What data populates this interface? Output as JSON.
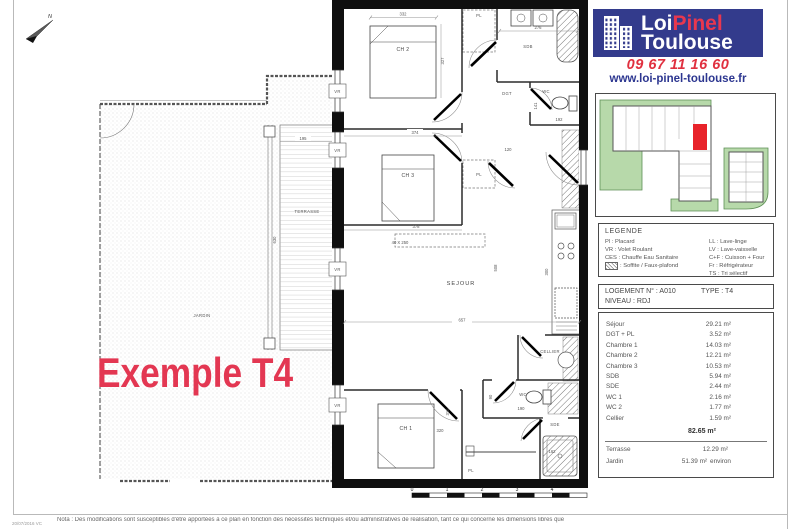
{
  "brand": {
    "logo": {
      "line1_a": "Loi",
      "line1_b": "Pinel",
      "line2": "Toulouse"
    },
    "phone": "09 67 11 16 60",
    "website": "www.loi-pinel-toulouse.fr",
    "colors": {
      "logo_bg": "#333b8c",
      "accent_red": "#e8374f",
      "site_highlight": "#e8232a"
    }
  },
  "legend": {
    "title": "LEGENDE",
    "left": [
      "Pl : Placard",
      "VR : Volet Roulant",
      "CES : Chauffe Eau Sanitaire",
      ": Soffite / Faux-plafond"
    ],
    "right": [
      "LL : Lave-linge",
      "LV : Lave-vaisselle",
      "C+F : Cuisson + Four",
      "Fr : Réfrigérateur",
      "TS : Tri sélectif"
    ]
  },
  "unit": {
    "lot": "LOGEMENT N° : A010",
    "type": "TYPE : T4",
    "level": "NIVEAU : RDJ"
  },
  "areas": {
    "rows": [
      {
        "label": "Séjour",
        "value": "29.21 m²"
      },
      {
        "label": "DGT + PL",
        "value": "3.52 m²"
      },
      {
        "label": "Chambre 1",
        "value": "14.03 m²"
      },
      {
        "label": "Chambre 2",
        "value": "12.21 m²"
      },
      {
        "label": "Chambre 3",
        "value": "10.53 m²"
      },
      {
        "label": "SDB",
        "value": "5.94 m²"
      },
      {
        "label": "SDE",
        "value": "2.44 m²"
      },
      {
        "label": "WC 1",
        "value": "2.16 m²"
      },
      {
        "label": "WC 2",
        "value": "1.77 m²"
      },
      {
        "label": "Cellier",
        "value": "1.59 m²"
      }
    ],
    "total": "82.65 m²",
    "outdoor": [
      {
        "label": "Terrasse",
        "value": "12.29 m²",
        "suffix": ""
      },
      {
        "label": "Jardin",
        "value": "51.39 m²",
        "suffix": "environ"
      }
    ]
  },
  "plan": {
    "example_label": "Exemple T4",
    "north_label": "N",
    "labels": {
      "ch1": "CH 1",
      "ch2": "CH 2",
      "ch3": "CH 3",
      "sdb": "SDB",
      "sde": "SDE",
      "wc": "WC",
      "dgt": "DGT",
      "pl": "PL",
      "sejour": "SEJOUR",
      "cellier": "CELLIER",
      "terrasse": "TERRASSE",
      "jardin": "JARDIN",
      "vr": "VR",
      "dressing": "40 X 250"
    },
    "dims": {
      "d332": "332",
      "d327": "327",
      "d374": "374",
      "d378": "378",
      "d276": "276",
      "d120": "120",
      "d141": "141",
      "d192": "192",
      "d508": "508",
      "d657": "657",
      "d300": "300",
      "d310": "310",
      "d320": "320",
      "d190": "190",
      "d90": "90",
      "d162": "162",
      "d195": "195",
      "d630": "630"
    },
    "scale": [
      "0",
      "1",
      "2",
      "3",
      "4"
    ]
  },
  "footer": {
    "note": "Nota : Des modifications sont susceptibles d'être apportées à ce plan en fonction des nécessités techniques et/ou administratives de réalisation, tant ce qui concerne les dimensions libres que",
    "ref": "20/07/2016 VC"
  }
}
